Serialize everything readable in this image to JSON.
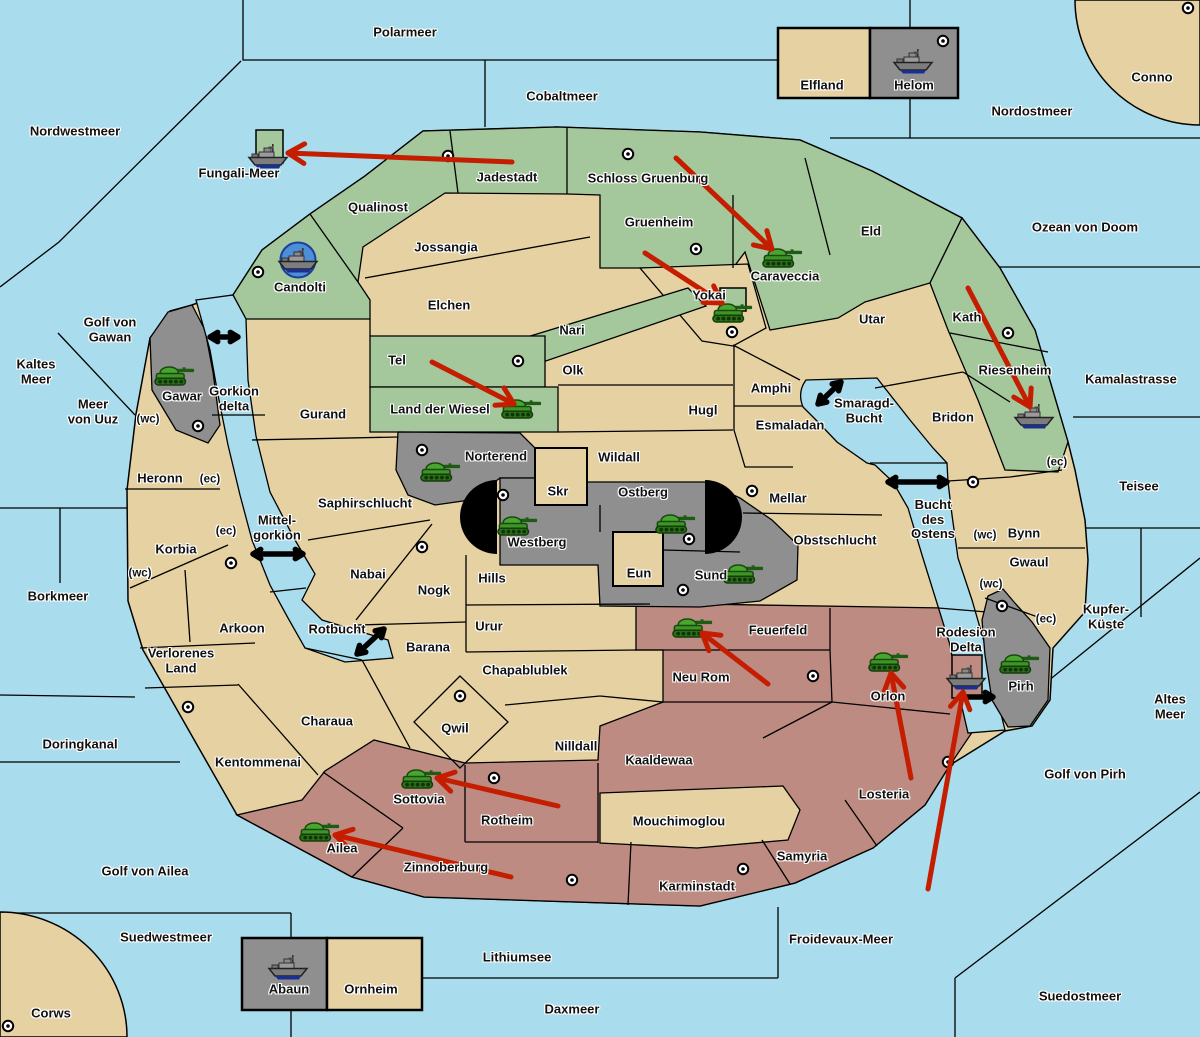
{
  "map_title": "Fantasy conquest map",
  "colors": {
    "sea": "#a9dcec",
    "land": "#e6d1a2",
    "green_power": "#a4c79c",
    "red_power": "#bd8b82",
    "gray_power": "#8f8f8f",
    "impassable": "#000000",
    "move_arrow": "#c41d00",
    "strait_arrow": "#000000",
    "port_circle": "#4d8ed6",
    "supply_center": "#ffffff"
  },
  "seas": [
    {
      "name": "Polarmeer",
      "x": 405,
      "y": 33
    },
    {
      "name": "Cobaltmeer",
      "x": 562,
      "y": 97
    },
    {
      "name": "Nordostmeer",
      "x": 1032,
      "y": 112
    },
    {
      "name": "Conno",
      "x": 1152,
      "y": 78
    },
    {
      "name": "Nordwestmeer",
      "x": 75,
      "y": 132
    },
    {
      "name": "Fungali-Meer",
      "x": 239,
      "y": 174
    },
    {
      "name": "Ozean von Doom",
      "x": 1085,
      "y": 228
    },
    {
      "name": "Kaltes\nMeer",
      "x": 36,
      "y": 372
    },
    {
      "name": "Golf von\nGawan",
      "x": 110,
      "y": 330
    },
    {
      "name": "Meer\nvon Uuz",
      "x": 93,
      "y": 412
    },
    {
      "name": "Gorkion\ndelta",
      "x": 234,
      "y": 399
    },
    {
      "name": "Kamalastrasse",
      "x": 1131,
      "y": 380
    },
    {
      "name": "Teisee",
      "x": 1139,
      "y": 487
    },
    {
      "name": "Mittel-\ngorkion",
      "x": 277,
      "y": 528
    },
    {
      "name": "Smaragd-\nBucht",
      "x": 864,
      "y": 411
    },
    {
      "name": "Bucht\ndes\nOstens",
      "x": 933,
      "y": 520
    },
    {
      "name": "Borkmeer",
      "x": 58,
      "y": 597
    },
    {
      "name": "Rotbucht",
      "x": 337,
      "y": 630
    },
    {
      "name": "Kupfer-\nKüste",
      "x": 1106,
      "y": 617
    },
    {
      "name": "Altes\nMeer",
      "x": 1170,
      "y": 707
    },
    {
      "name": "Golf von Pirh",
      "x": 1085,
      "y": 775
    },
    {
      "name": "Doringkanal",
      "x": 80,
      "y": 745
    },
    {
      "name": "Golf von Ailea",
      "x": 145,
      "y": 872
    },
    {
      "name": "Suedwestmeer",
      "x": 166,
      "y": 938
    },
    {
      "name": "Corws",
      "x": 51,
      "y": 1014
    },
    {
      "name": "Lithiumsee",
      "x": 517,
      "y": 958
    },
    {
      "name": "Daxmeer",
      "x": 572,
      "y": 1010
    },
    {
      "name": "Froidevaux-Meer",
      "x": 841,
      "y": 940
    },
    {
      "name": "Suedostmeer",
      "x": 1080,
      "y": 997
    },
    {
      "name": "Rodesion\nDelta",
      "x": 966,
      "y": 640
    }
  ],
  "territories": [
    {
      "name": "Elfland",
      "x": 822,
      "y": 86
    },
    {
      "name": "Helom",
      "x": 914,
      "y": 86
    },
    {
      "name": "Jadestadt",
      "x": 507,
      "y": 178
    },
    {
      "name": "Schloss Gruenburg",
      "x": 648,
      "y": 179
    },
    {
      "name": "Qualinost",
      "x": 378,
      "y": 208
    },
    {
      "name": "Gruenheim",
      "x": 659,
      "y": 223
    },
    {
      "name": "Eld",
      "x": 871,
      "y": 232
    },
    {
      "name": "Jossangia",
      "x": 446,
      "y": 248
    },
    {
      "name": "Caraveccia",
      "x": 785,
      "y": 277
    },
    {
      "name": "Candolti",
      "x": 300,
      "y": 288
    },
    {
      "name": "Elchen",
      "x": 449,
      "y": 306
    },
    {
      "name": "Yokai",
      "x": 709,
      "y": 296
    },
    {
      "name": "Utar",
      "x": 872,
      "y": 320
    },
    {
      "name": "Kath",
      "x": 967,
      "y": 318
    },
    {
      "name": "Nari",
      "x": 572,
      "y": 331
    },
    {
      "name": "Tel",
      "x": 397,
      "y": 361
    },
    {
      "name": "Olk",
      "x": 573,
      "y": 371
    },
    {
      "name": "Amphi",
      "x": 771,
      "y": 389
    },
    {
      "name": "Riesenheim",
      "x": 1015,
      "y": 371
    },
    {
      "name": "Land der Wiesel",
      "x": 440,
      "y": 410
    },
    {
      "name": "Hugl",
      "x": 703,
      "y": 411
    },
    {
      "name": "Esmaladan",
      "x": 790,
      "y": 426
    },
    {
      "name": "Bridon",
      "x": 953,
      "y": 418
    },
    {
      "name": "Gurand",
      "x": 323,
      "y": 415
    },
    {
      "name": "Norterend",
      "x": 496,
      "y": 457
    },
    {
      "name": "Wildall",
      "x": 619,
      "y": 458
    },
    {
      "name": "Gawar",
      "x": 182,
      "y": 397
    },
    {
      "name": "Heronn",
      "x": 160,
      "y": 479
    },
    {
      "name": "Saphirschlucht",
      "x": 365,
      "y": 504
    },
    {
      "name": "Skr",
      "x": 558,
      "y": 492
    },
    {
      "name": "Ostberg",
      "x": 643,
      "y": 493
    },
    {
      "name": "Mellar",
      "x": 788,
      "y": 499
    },
    {
      "name": "Korbia",
      "x": 176,
      "y": 550
    },
    {
      "name": "Westberg",
      "x": 537,
      "y": 543
    },
    {
      "name": "Obstschlucht",
      "x": 835,
      "y": 541
    },
    {
      "name": "Bynn",
      "x": 1024,
      "y": 534
    },
    {
      "name": "Gwaul",
      "x": 1029,
      "y": 563
    },
    {
      "name": "Nabai",
      "x": 368,
      "y": 575
    },
    {
      "name": "Nogk",
      "x": 434,
      "y": 591
    },
    {
      "name": "Hills",
      "x": 492,
      "y": 579
    },
    {
      "name": "Eun",
      "x": 639,
      "y": 574
    },
    {
      "name": "Sund",
      "x": 711,
      "y": 576
    },
    {
      "name": "Urur",
      "x": 489,
      "y": 627
    },
    {
      "name": "Feuerfeld",
      "x": 778,
      "y": 631
    },
    {
      "name": "Arkoon",
      "x": 242,
      "y": 629
    },
    {
      "name": "Barana",
      "x": 428,
      "y": 648
    },
    {
      "name": "Neu Rom",
      "x": 701,
      "y": 678
    },
    {
      "name": "Orlon",
      "x": 888,
      "y": 697
    },
    {
      "name": "Pirh",
      "x": 1021,
      "y": 687
    },
    {
      "name": "Verlorenes\nLand",
      "x": 181,
      "y": 661
    },
    {
      "name": "Chapablublek",
      "x": 525,
      "y": 671
    },
    {
      "name": "Qwil",
      "x": 455,
      "y": 729
    },
    {
      "name": "Charaua",
      "x": 327,
      "y": 722
    },
    {
      "name": "Nilldall",
      "x": 576,
      "y": 747
    },
    {
      "name": "Kaaldewaa",
      "x": 659,
      "y": 761
    },
    {
      "name": "Losteria",
      "x": 884,
      "y": 795
    },
    {
      "name": "Kentommenai",
      "x": 258,
      "y": 763
    },
    {
      "name": "Sottovia",
      "x": 419,
      "y": 800
    },
    {
      "name": "Rotheim",
      "x": 507,
      "y": 821
    },
    {
      "name": "Mouchimoglou",
      "x": 679,
      "y": 822
    },
    {
      "name": "Ailea",
      "x": 342,
      "y": 849
    },
    {
      "name": "Zinnoberburg",
      "x": 446,
      "y": 868
    },
    {
      "name": "Samyria",
      "x": 802,
      "y": 857
    },
    {
      "name": "Karminstadt",
      "x": 697,
      "y": 887
    },
    {
      "name": "Abaun",
      "x": 289,
      "y": 990
    },
    {
      "name": "Ornheim",
      "x": 371,
      "y": 990
    }
  ],
  "coast_markers": [
    {
      "name": "(wc)",
      "x": 148,
      "y": 420
    },
    {
      "name": "(ec)",
      "x": 210,
      "y": 480
    },
    {
      "name": "(ec)",
      "x": 226,
      "y": 532
    },
    {
      "name": "(wc)",
      "x": 140,
      "y": 574
    },
    {
      "name": "(wc)",
      "x": 985,
      "y": 536
    },
    {
      "name": "(ec)",
      "x": 1057,
      "y": 463
    },
    {
      "name": "(wc)",
      "x": 991,
      "y": 585
    },
    {
      "name": "(ec)",
      "x": 1046,
      "y": 620
    }
  ],
  "supply_centers": [
    {
      "at": "Jadestadt",
      "x": 448,
      "y": 156
    },
    {
      "at": "Schloss Gruenburg",
      "x": 628,
      "y": 154
    },
    {
      "at": "Gruenheim",
      "x": 696,
      "y": 249
    },
    {
      "at": "Helom",
      "x": 943,
      "y": 41
    },
    {
      "at": "Conno",
      "x": 1188,
      "y": 8
    },
    {
      "at": "Candolti",
      "x": 258,
      "y": 272
    },
    {
      "at": "Tel",
      "x": 518,
      "y": 361
    },
    {
      "at": "Yokai",
      "x": 732,
      "y": 332
    },
    {
      "at": "Kath",
      "x": 1008,
      "y": 333
    },
    {
      "at": "Bynn",
      "x": 973,
      "y": 482
    },
    {
      "at": "Mellar",
      "x": 752,
      "y": 491
    },
    {
      "at": "Westberg",
      "x": 503,
      "y": 495
    },
    {
      "at": "Ostberg",
      "x": 689,
      "y": 539
    },
    {
      "at": "Sund",
      "x": 683,
      "y": 590
    },
    {
      "at": "Norterend",
      "x": 422,
      "y": 450
    },
    {
      "at": "Gawar",
      "x": 198,
      "y": 426
    },
    {
      "at": "Korbia",
      "x": 231,
      "y": 563
    },
    {
      "at": "Nabai",
      "x": 422,
      "y": 547
    },
    {
      "at": "Qwil",
      "x": 460,
      "y": 696
    },
    {
      "at": "Rotheim",
      "x": 494,
      "y": 778
    },
    {
      "at": "Zinnoberburg",
      "x": 572,
      "y": 880
    },
    {
      "at": "Karminstadt",
      "x": 743,
      "y": 869
    },
    {
      "at": "Neu Rom",
      "x": 813,
      "y": 676
    },
    {
      "at": "Losteria",
      "x": 948,
      "y": 762
    },
    {
      "at": "Pirh",
      "x": 1002,
      "y": 606
    },
    {
      "at": "Corws",
      "x": 8,
      "y": 1026
    },
    {
      "at": "Verlorenes Land",
      "x": 188,
      "y": 707
    }
  ],
  "units": [
    {
      "type": "army",
      "at": "Caraveccia",
      "x": 783,
      "y": 256
    },
    {
      "type": "army",
      "at": "Yokai",
      "x": 733,
      "y": 311
    },
    {
      "type": "army",
      "at": "Land der Wiesel",
      "x": 522,
      "y": 407
    },
    {
      "type": "army",
      "at": "Gawar",
      "x": 175,
      "y": 374
    },
    {
      "type": "army",
      "at": "Norterend",
      "x": 441,
      "y": 470
    },
    {
      "type": "army",
      "at": "Westberg",
      "x": 518,
      "y": 524
    },
    {
      "type": "army",
      "at": "Ostberg",
      "x": 676,
      "y": 522
    },
    {
      "type": "army",
      "at": "Sund",
      "x": 744,
      "y": 572
    },
    {
      "type": "army",
      "at": "Feuerfeld",
      "x": 693,
      "y": 626
    },
    {
      "type": "army",
      "at": "Orlon",
      "x": 889,
      "y": 660
    },
    {
      "type": "army",
      "at": "Pirh",
      "x": 1020,
      "y": 662
    },
    {
      "type": "army",
      "at": "Ailea",
      "x": 320,
      "y": 830
    },
    {
      "type": "army",
      "at": "Sottovia",
      "x": 422,
      "y": 777
    },
    {
      "type": "fleet",
      "at": "Fungali-Meer",
      "x": 268,
      "y": 156
    },
    {
      "type": "fleet",
      "at": "Candolti",
      "x": 298,
      "y": 260
    },
    {
      "type": "fleet",
      "at": "Helom",
      "x": 913,
      "y": 61
    },
    {
      "type": "fleet",
      "at": "Riesenheim",
      "x": 1034,
      "y": 416
    },
    {
      "type": "fleet",
      "at": "Rodesion Delta",
      "x": 966,
      "y": 677
    },
    {
      "type": "fleet",
      "at": "Abaun",
      "x": 288,
      "y": 967
    }
  ],
  "move_arrows": [
    {
      "from_name": "Jadestadt",
      "to_name": "Fungali-Meer",
      "x1": 512,
      "y1": 162,
      "x2": 288,
      "y2": 153
    },
    {
      "from_name": "Schloss Gruenburg",
      "to_name": "Caraveccia",
      "x1": 676,
      "y1": 158,
      "x2": 772,
      "y2": 249
    },
    {
      "from_name": "Gruenheim",
      "to_name": "Yokai",
      "x1": 645,
      "y1": 253,
      "x2": 722,
      "y2": 303
    },
    {
      "from_name": "Tel",
      "to_name": "Land der Wiesel",
      "x1": 432,
      "y1": 362,
      "x2": 514,
      "y2": 404
    },
    {
      "from_name": "Kath",
      "to_name": "Riesenheim",
      "x1": 968,
      "y1": 288,
      "x2": 1030,
      "y2": 407
    },
    {
      "from_name": "Neu Rom",
      "to_name": "Feuerfeld",
      "x1": 768,
      "y1": 684,
      "x2": 702,
      "y2": 633
    },
    {
      "from_name": "Losteria",
      "to_name": "Orlon",
      "x1": 911,
      "y1": 778,
      "x2": 891,
      "y2": 673
    },
    {
      "from_name": "Froidevaux-Meer",
      "to_name": "Rodesion Delta",
      "x1": 928,
      "y1": 889,
      "x2": 963,
      "y2": 692
    },
    {
      "from_name": "Rotheim",
      "to_name": "Sottovia",
      "x1": 558,
      "y1": 806,
      "x2": 437,
      "y2": 778
    },
    {
      "from_name": "Zinnoberburg",
      "to_name": "Ailea",
      "x1": 511,
      "y1": 877,
      "x2": 335,
      "y2": 835
    }
  ],
  "strait_arrows": [
    {
      "at": "Gorkion delta",
      "x1": 210,
      "y1": 337,
      "x2": 238,
      "y2": 337,
      "heads": 2
    },
    {
      "at": "Mittel-gorkion",
      "x1": 253,
      "y1": 554,
      "x2": 303,
      "y2": 554,
      "heads": 2
    },
    {
      "at": "Rotbucht",
      "x1": 357,
      "y1": 654,
      "x2": 384,
      "y2": 629,
      "heads": 2
    },
    {
      "at": "Smaragd-Bucht",
      "x1": 818,
      "y1": 404,
      "x2": 841,
      "y2": 382,
      "heads": 2
    },
    {
      "at": "Bucht des Ostens",
      "x1": 888,
      "y1": 482,
      "x2": 947,
      "y2": 482,
      "heads": 2
    },
    {
      "at": "Rodesion Delta",
      "x1": 962,
      "y1": 697,
      "x2": 993,
      "y2": 697,
      "heads": 1
    }
  ]
}
